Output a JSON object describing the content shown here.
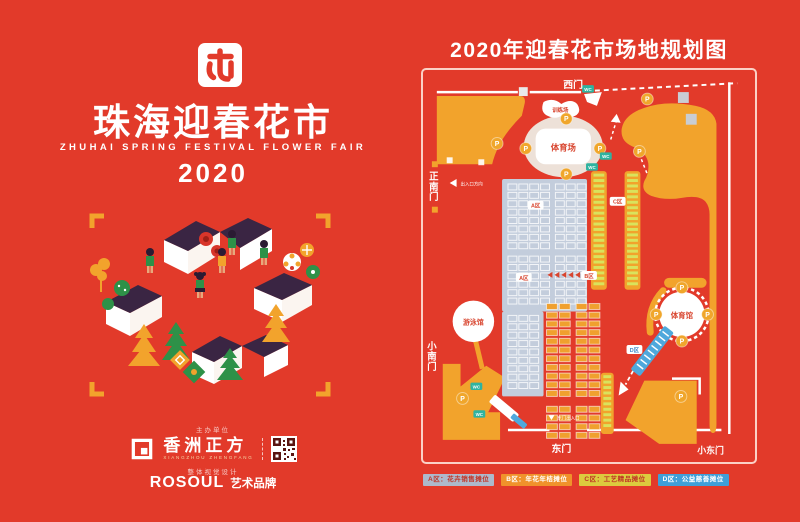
{
  "poster": {
    "title": "珠海迎春花市",
    "subtitle": "ZHUHAI SPRING FESTIVAL FLOWER FAIR",
    "year": "2020",
    "footer": {
      "organizer_label": "主办单位",
      "brand_cn": "香洲正方",
      "brand_en": "XIANGZHOU ZHENGFANG",
      "design_label": "整体视觉设计",
      "design_brand": "ROSOUL",
      "design_brand_suffix": "艺术品牌"
    }
  },
  "map": {
    "title": "2020年迎春花市场地规划图",
    "gates": {
      "west": "西门",
      "main_south": "正南门",
      "small_south": "小南门",
      "east": "东门",
      "small_east": "小东门"
    },
    "venues": {
      "stadium": "体育场",
      "training_ground": "训练场",
      "natatorium": "游泳馆",
      "gymnasium": "体育馆"
    },
    "zone_badges": {
      "a": "A区",
      "a2": "A区",
      "b": "B区",
      "c": "C区",
      "d": "D区"
    },
    "markers": {
      "parking": "P",
      "toilet": "WC"
    },
    "wayfinding": {
      "west_exit": "出入口方向",
      "east_exit": "东门出入口"
    },
    "legend": [
      {
        "label": "A区：花卉销售摊位",
        "color": "#ADB9CB"
      },
      {
        "label": "B区：年花年桔摊位",
        "color": "#F0922B"
      },
      {
        "label": "C区：工艺精品摊位",
        "color": "#DCCB3E"
      },
      {
        "label": "D区：公益慈善摊位",
        "color": "#3F9FD8"
      }
    ]
  },
  "colors": {
    "background": "#E23A2A",
    "accent_orange": "#F2A32C",
    "roof_purple": "#3A2543",
    "stall_gray": "#C3CDDC",
    "ladder_green": "#D9E35C",
    "strip_blue": "#4FA8DC",
    "wc_teal": "#2FB3A0",
    "parking_yellow": "#F0A62B"
  }
}
